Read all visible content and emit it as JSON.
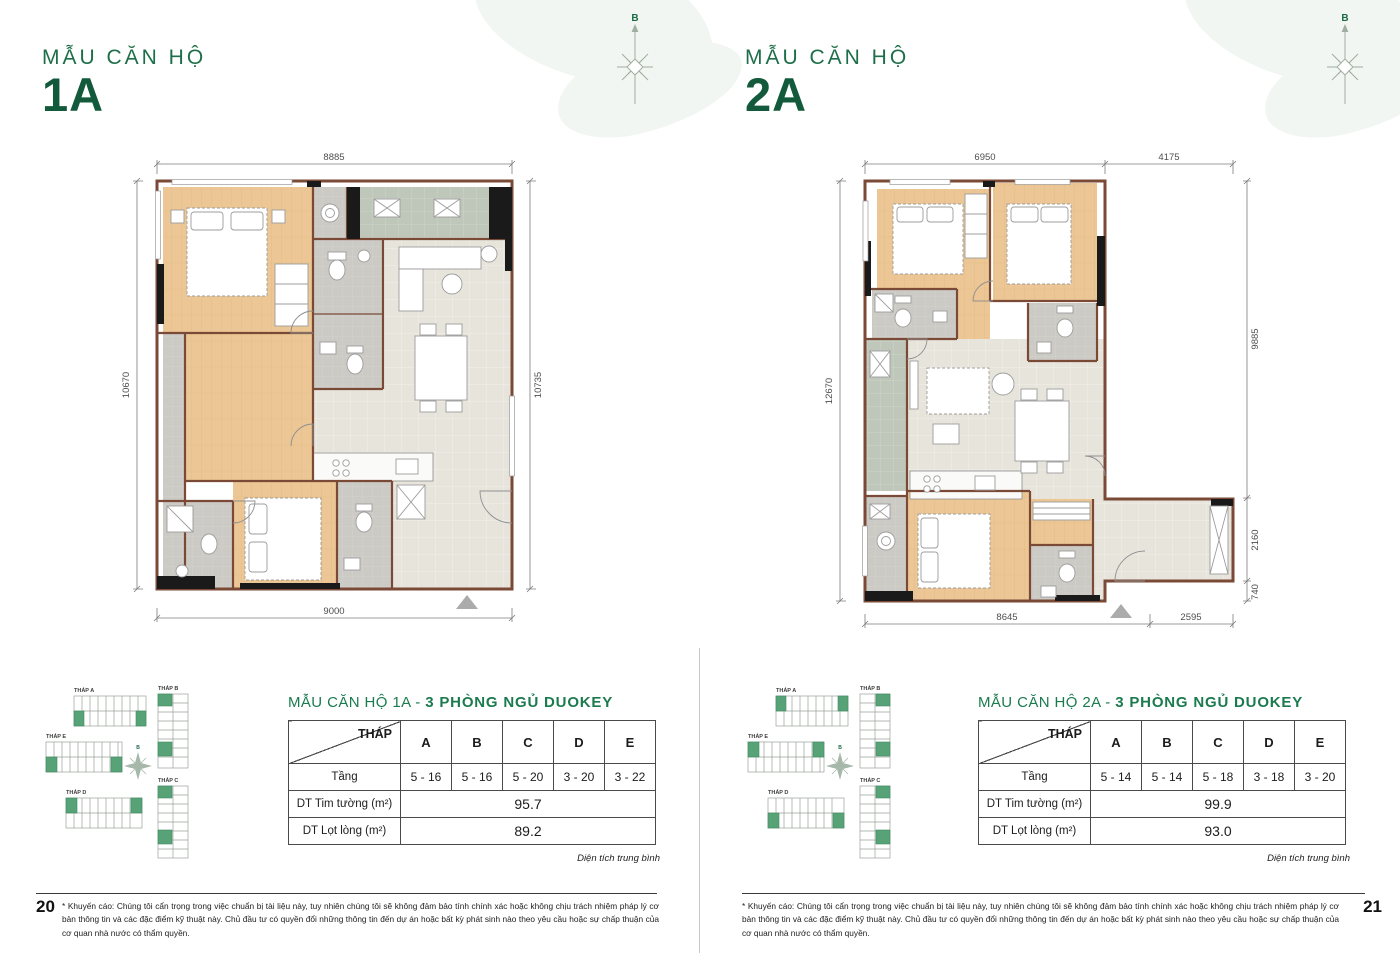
{
  "compass_label": "B",
  "area_note": "Diện tích trung bình",
  "disclaimer": "* Khuyến cáo: Chúng tôi cẩn trọng trong việc chuẩn bị tài liệu này, tuy nhiên chúng tôi sẽ không đảm bảo tính chính xác hoặc không chịu trách nhiệm pháp lý cơ bản thông tin và các đặc điểm kỹ thuật này. Chủ đầu tư có quyền đổi những thông tin đến dự án hoặc bất kỳ phát sinh nào theo yêu cầu hoặc sự chấp thuận của cơ quan nhà nước có thẩm quyền.",
  "keyplan": {
    "tower_a": "THÁP A",
    "tower_b": "THÁP B",
    "tower_c": "THÁP C",
    "tower_d": "THÁP D",
    "tower_e": "THÁP E"
  },
  "left_page": {
    "page_number": "20",
    "title_line1": "MẪU CĂN HỘ",
    "title_line2": "1A",
    "dims": {
      "top": "8885",
      "left": "10670",
      "right": "10735",
      "bottom": "9000"
    },
    "table": {
      "title_plain": "MẪU CĂN HỘ 1A - ",
      "title_bold": "3 PHÒNG NGỦ DUOKEY",
      "corner": "THÁP",
      "col_a": "A",
      "col_b": "B",
      "col_c": "C",
      "col_d": "D",
      "col_e": "E",
      "floor_label": "Tầng",
      "floor_a": "5 - 16",
      "floor_b": "5 - 16",
      "floor_c": "5 - 20",
      "floor_d": "3 - 20",
      "floor_e": "3 - 22",
      "gross_label": "DT Tim tường (m²)",
      "gross_value": "95.7",
      "net_label": "DT Lọt lòng (m²)",
      "net_value": "89.2"
    }
  },
  "right_page": {
    "page_number": "21",
    "title_line1": "MẪU CĂN HỘ",
    "title_line2": "2A",
    "dims": {
      "top_left": "6950",
      "top_right": "4175",
      "left": "12670",
      "right_top": "9885",
      "right_mid": "2160",
      "right_bottom": "740",
      "bottom_left": "8645",
      "bottom_right": "2595"
    },
    "table": {
      "title_plain": "MẪU CĂN HỘ 2A - ",
      "title_bold": "3 PHÒNG NGỦ DUOKEY",
      "corner": "THÁP",
      "col_a": "A",
      "col_b": "B",
      "col_c": "C",
      "col_d": "D",
      "col_e": "E",
      "floor_label": "Tầng",
      "floor_a": "5 - 14",
      "floor_b": "5 - 14",
      "floor_c": "5 - 18",
      "floor_d": "3 - 18",
      "floor_e": "3 - 20",
      "gross_label": "DT Tim tường (m²)",
      "gross_value": "99.9",
      "net_label": "DT Lọt lòng (m²)",
      "net_value": "93.0"
    }
  }
}
